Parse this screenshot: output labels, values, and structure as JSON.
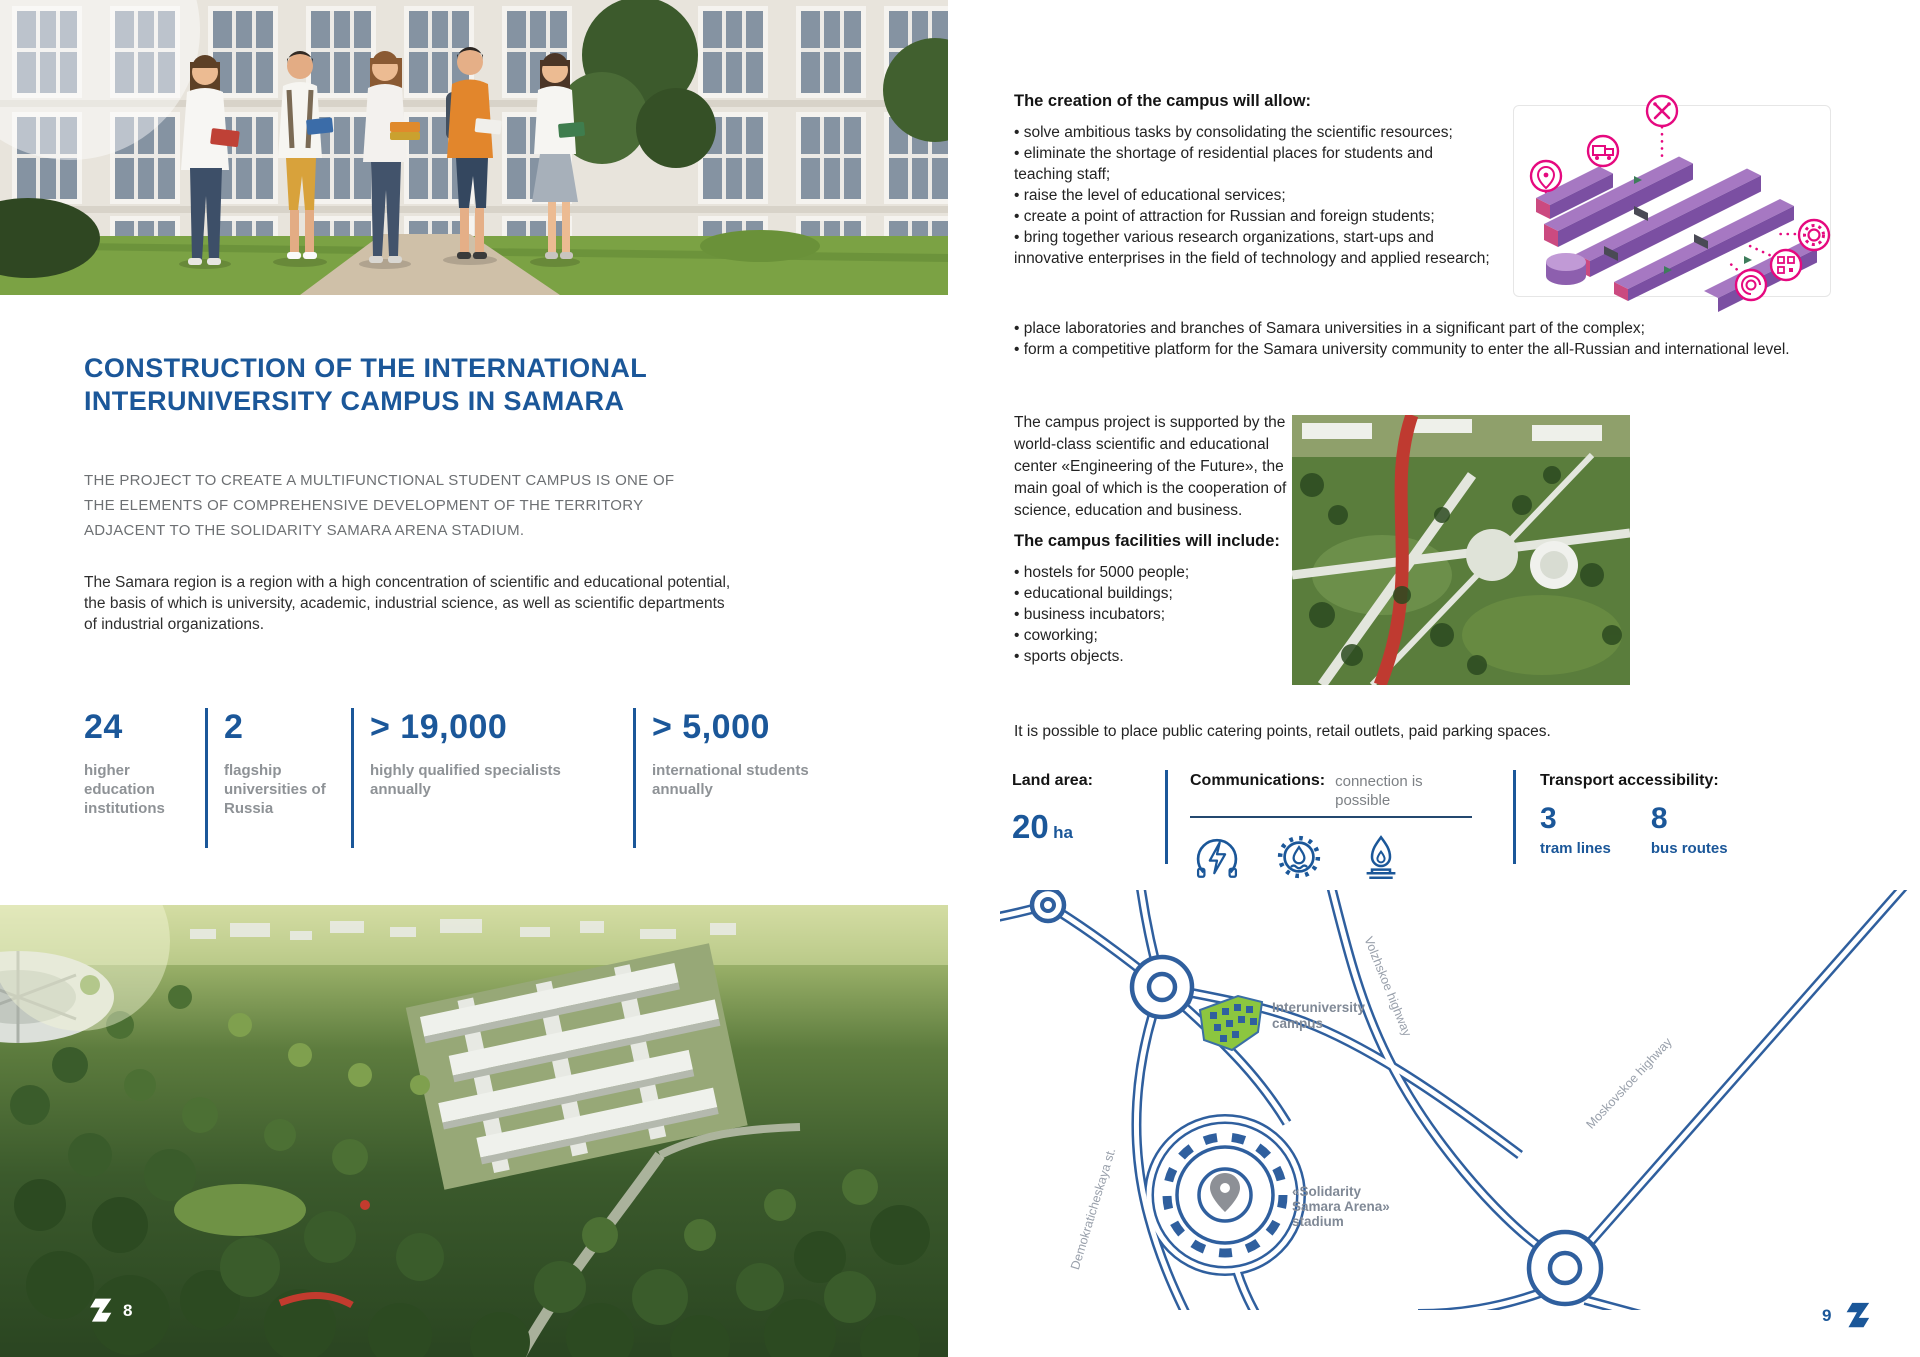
{
  "colors": {
    "accent_blue": "#1b5799",
    "stat_gray": "#8e9296",
    "map_blue": "#2f5f9e",
    "campus_green": "#8cc63f",
    "diagram_pink": "#e5097f",
    "diagram_purple": "#a678c2"
  },
  "left_page": {
    "title_line1": "CONSTRUCTION OF THE INTERNATIONAL",
    "title_line2": "INTERUNIVERSITY CAMPUS IN SAMARA",
    "subtitle": "THE PROJECT TO CREATE A MULTIFUNCTIONAL STUDENT CAMPUS IS ONE OF THE ELEMENTS OF COMPREHENSIVE DEVELOPMENT OF THE TERRITORY ADJACENT TO THE SOLIDARITY SAMARA ARENA STADIUM.",
    "body": "The Samara region is a region with a high concentration of scientific and educational potential, the basis of which is university, academic, industrial science, as well as scientific departments of industrial organizations.",
    "stats": [
      {
        "value": "24",
        "label": "higher education institutions"
      },
      {
        "value": "2",
        "label": "flagship universities of Russia"
      },
      {
        "value": "> 19,000",
        "label": "highly qualified specialists annually"
      },
      {
        "value": "> 5,000",
        "label": "international students annually"
      }
    ],
    "page_number": "8"
  },
  "right_page": {
    "creation_heading": "The creation of the campus will allow:",
    "creation_bullets": [
      "• solve ambitious tasks by consolidating the scientific resources;",
      "• eliminate the shortage of residential places for students and teaching staff;",
      "• raise the level of educational services;",
      "• create a point of attraction for Russian and foreign students;",
      "• bring together various research organizations, start-ups and innovative enterprises in the field of technology and applied research;",
      "• place laboratories and branches of Samara universities in a significant part of the complex;",
      "• form a competitive platform for the Samara university community to enter the all-Russian and international level."
    ],
    "support_paragraph": "The campus project is supported by the world-class scientific and educational center «Engineering of the Future», the main goal of which is the cooperation of science, education and business.",
    "facilities_heading": "The campus facilities will include:",
    "facilities_bullets": [
      "• hostels for 5000 people;",
      "• educational buildings;",
      "• business incubators;",
      "• coworking;",
      "• sports objects."
    ],
    "catering_text": "It is possible to place public catering points, retail outlets, paid parking spaces.",
    "land_area": {
      "label": "Land area:",
      "value": "20",
      "unit": "ha"
    },
    "communications": {
      "label": "Communications:",
      "note": "connection is possible",
      "icons": [
        "electricity-icon",
        "water-icon",
        "gas-icon"
      ]
    },
    "transport": {
      "label": "Transport accessibility:",
      "items": [
        {
          "value": "3",
          "label": "tram lines"
        },
        {
          "value": "8",
          "label": "bus routes"
        }
      ]
    },
    "diagram_icons": [
      "location-pin-icon",
      "truck-icon",
      "tools-icon",
      "gear-icon",
      "qr-icon",
      "motor-icon"
    ],
    "map_labels": {
      "campus_line1": "Interuniversity",
      "campus_line2": "campus",
      "stadium_line1": "«Solidarity",
      "stadium_line2": "Samara Arena»",
      "stadium_line3": "stadium",
      "highway_volzhskoe": "Volzhskoe highway",
      "highway_moskovskoe": "Moskovskoe highway",
      "street_demokraticheskaya": "Demokraticheskaya st."
    },
    "page_number": "9"
  }
}
